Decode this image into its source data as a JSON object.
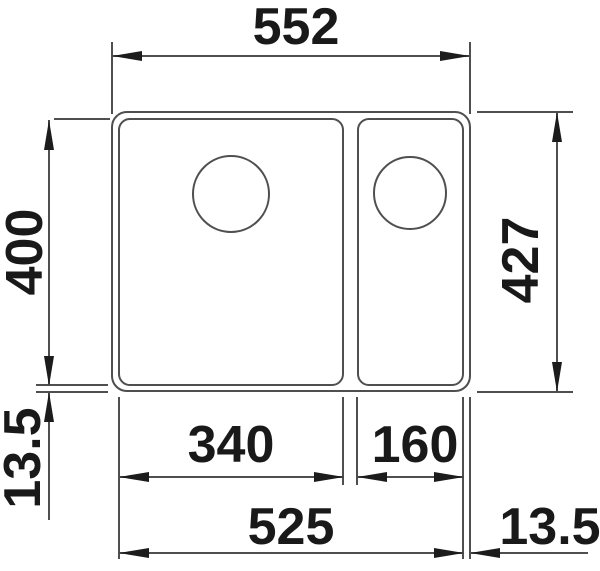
{
  "diagram": {
    "title": "sink-dimensional-drawing",
    "description": "Top view technical drawing of a kitchen sink with one main bowl and one half bowl, each with a round drain hole, annotated with millimeter dimensions",
    "units": "mm",
    "colors": {
      "line": "#4f4f4f",
      "text": "#191919",
      "background": "#ffffff"
    },
    "dimensions": {
      "top_width": "552",
      "left_height": "400",
      "right_height": "427",
      "left_rim": "13.5",
      "main_bowl_width": "340",
      "half_bowl_width": "160",
      "bottom_span": "525",
      "right_rim": "13.5"
    }
  }
}
